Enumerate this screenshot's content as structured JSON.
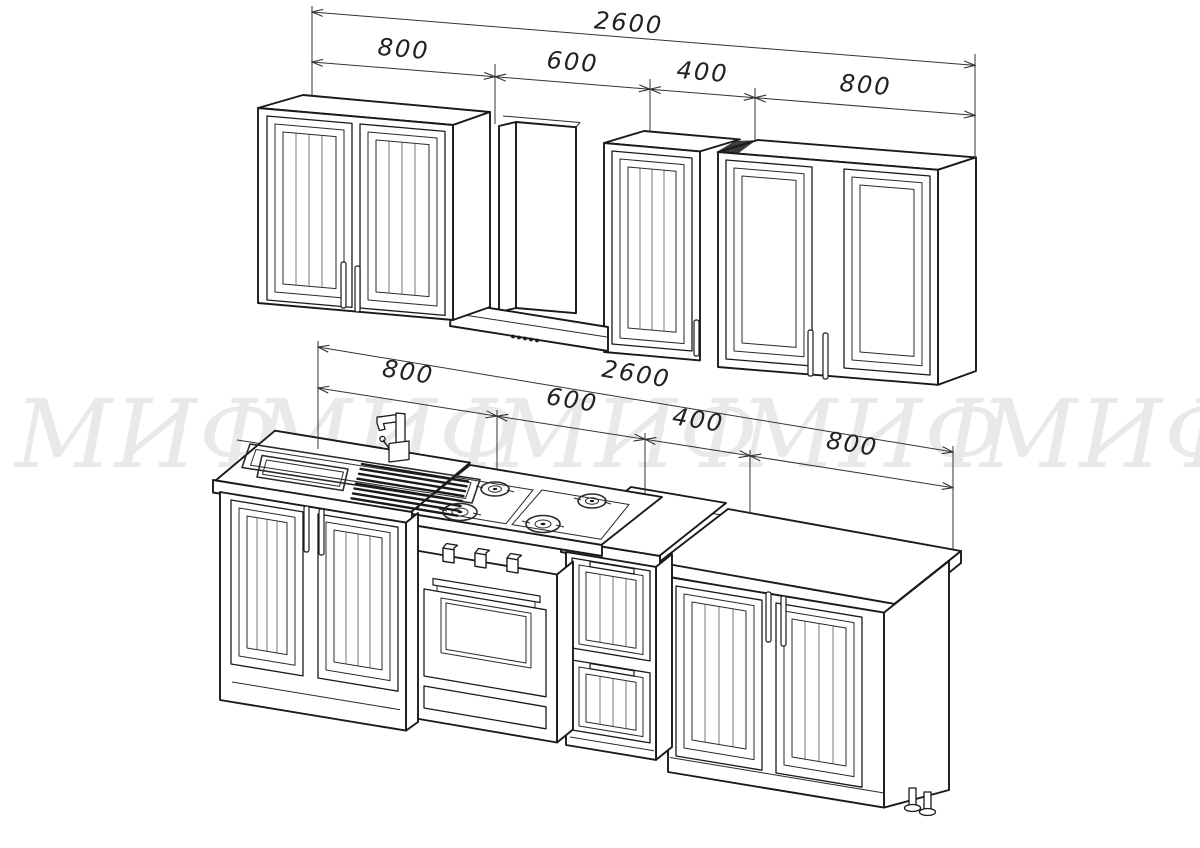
{
  "colors": {
    "background": "#ffffff",
    "line": "#1a1a1a",
    "dimension_text": "#222222",
    "watermark": "#e9e9e9"
  },
  "watermark": {
    "text": "МИФ",
    "repeat": 5
  },
  "dimensions": {
    "upper": {
      "total": "2600",
      "segments": [
        "800",
        "600",
        "400",
        "800"
      ]
    },
    "lower": {
      "total": "2600",
      "segments": [
        "800",
        "600",
        "400",
        "800"
      ]
    }
  }
}
